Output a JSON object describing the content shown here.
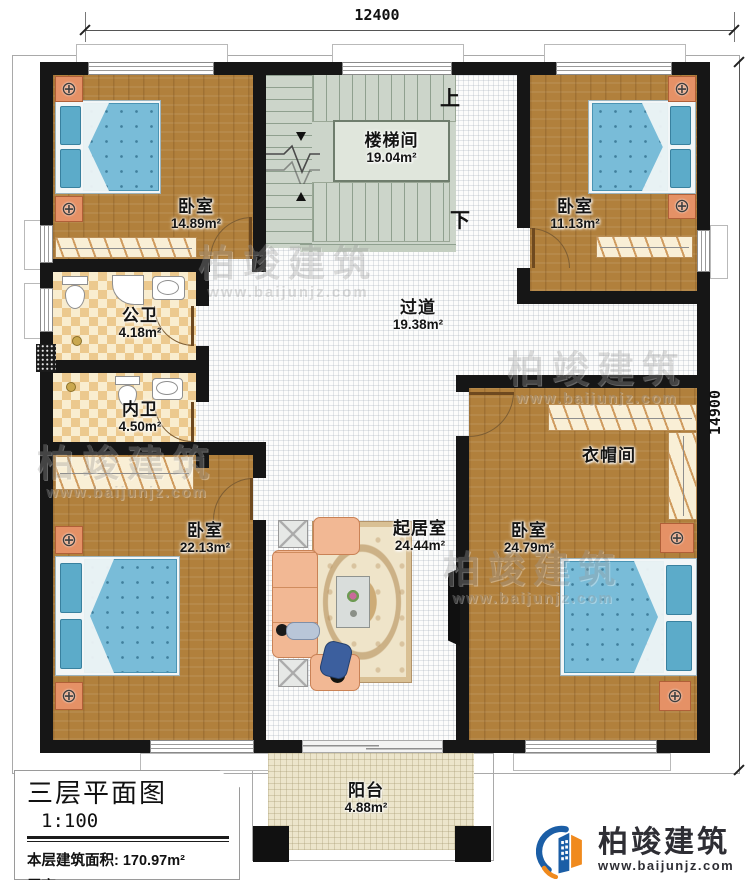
{
  "plan": {
    "dimension_top": "12400",
    "dimension_right": "14900",
    "stair_up": "上",
    "stair_down": "下"
  },
  "rooms": {
    "stairwell": {
      "name": "楼梯间",
      "area": "19.04m²"
    },
    "corridor": {
      "name": "过道",
      "area": "19.38m²"
    },
    "bedroom_top_left": {
      "name": "卧室",
      "area": "14.89m²"
    },
    "bedroom_top_right": {
      "name": "卧室",
      "area": "11.13m²"
    },
    "bath_public": {
      "name": "公卫",
      "area": "4.18m²"
    },
    "bath_private": {
      "name": "内卫",
      "area": "4.50m²"
    },
    "bedroom_bottom_left": {
      "name": "卧室",
      "area": "22.13m²"
    },
    "bedroom_bottom_right": {
      "name": "卧室",
      "area": "24.79m²"
    },
    "cloakroom": {
      "name": "衣帽间"
    },
    "living_room": {
      "name": "起居室",
      "area": "24.44m²"
    },
    "balcony": {
      "name": "阳台",
      "area": "4.88m²"
    }
  },
  "title_block": {
    "title": "三层平面图",
    "scale": "1:100",
    "floor_area": "本层建筑面积: 170.97m²",
    "floor_height": "层高: 3.3m"
  },
  "brand": {
    "name": "柏竣建筑",
    "url": "www.baijunjz.com"
  },
  "watermark": {
    "name": "柏竣建筑",
    "url": "www.baijunjz.com"
  },
  "icons": {
    "lamp": "⊕"
  },
  "colors": {
    "wall": "#161616",
    "wood": "#b1803c",
    "tile_dark": "#ecc98e",
    "tile_light": "#f9edcf",
    "mattress": "#79bcd8",
    "balcony_floor": "#ece5cb",
    "logo_blue": "#1b5ea6",
    "logo_orange": "#f08a1d"
  }
}
